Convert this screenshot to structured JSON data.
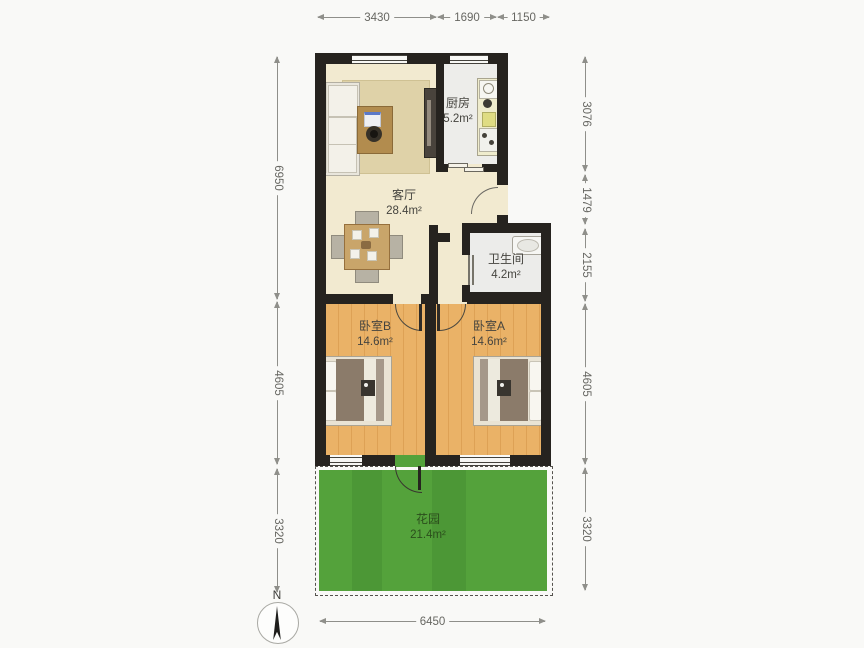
{
  "rooms": {
    "kitchen": {
      "name": "厨房",
      "area": "5.2m²"
    },
    "living": {
      "name": "客厅",
      "area": "28.4m²"
    },
    "bath": {
      "name": "卫生间",
      "area": "4.2m²"
    },
    "bedroomB": {
      "name": "卧室B",
      "area": "14.6m²"
    },
    "bedroomA": {
      "name": "卧室A",
      "area": "14.6m²"
    },
    "garden": {
      "name": "花园",
      "area": "21.4m²"
    }
  },
  "dimensions": {
    "top": [
      "3430",
      "1690",
      "1150"
    ],
    "left": [
      "6950",
      "4605",
      "3320"
    ],
    "right": [
      "3076",
      "1479",
      "2155",
      "4605",
      "3320"
    ],
    "bottom": [
      "6450"
    ]
  },
  "compass": {
    "north_label": "N"
  },
  "colors": {
    "wall": "#26231f",
    "living_floor": "#f2ead0",
    "bedroom_floor": "#eab267",
    "kitchen_floor": "#ededea",
    "bath_floor": "#ececea",
    "grass": "#54a23b",
    "rug": "#dfd2a8",
    "dimension_text": "#676762"
  }
}
